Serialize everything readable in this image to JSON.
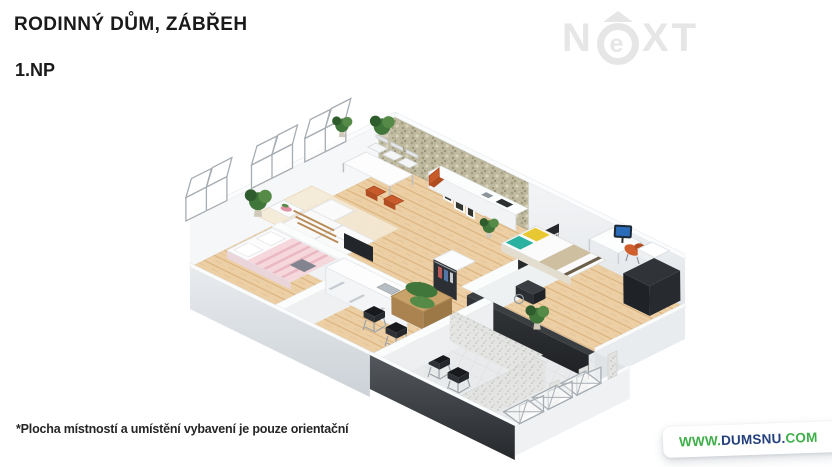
{
  "header": {
    "title": "RODINNÝ DŮM, ZÁBŘEH",
    "floor_label": "1.NP"
  },
  "watermark_logo": {
    "prefix": "N",
    "circled_letter": "e",
    "suffix": "XT"
  },
  "footnote": {
    "disclaimer": "*Plocha místností a umístění vybavení je pouze orientační"
  },
  "website_badge": {
    "www": "WWW.",
    "domain": "DUMSNU",
    "separator": ".",
    "tld": "COM"
  },
  "colors": {
    "accent_green": "#3fae49",
    "navy_blue": "#24407c",
    "title_text": "#1a1a1a",
    "watermark_gray": "#e6e6e6",
    "badge_bg": "#ffffff",
    "floor_wood": "#eccfa4",
    "stone_wall": "#bdb89e",
    "dark_wall": "#2f3235"
  }
}
